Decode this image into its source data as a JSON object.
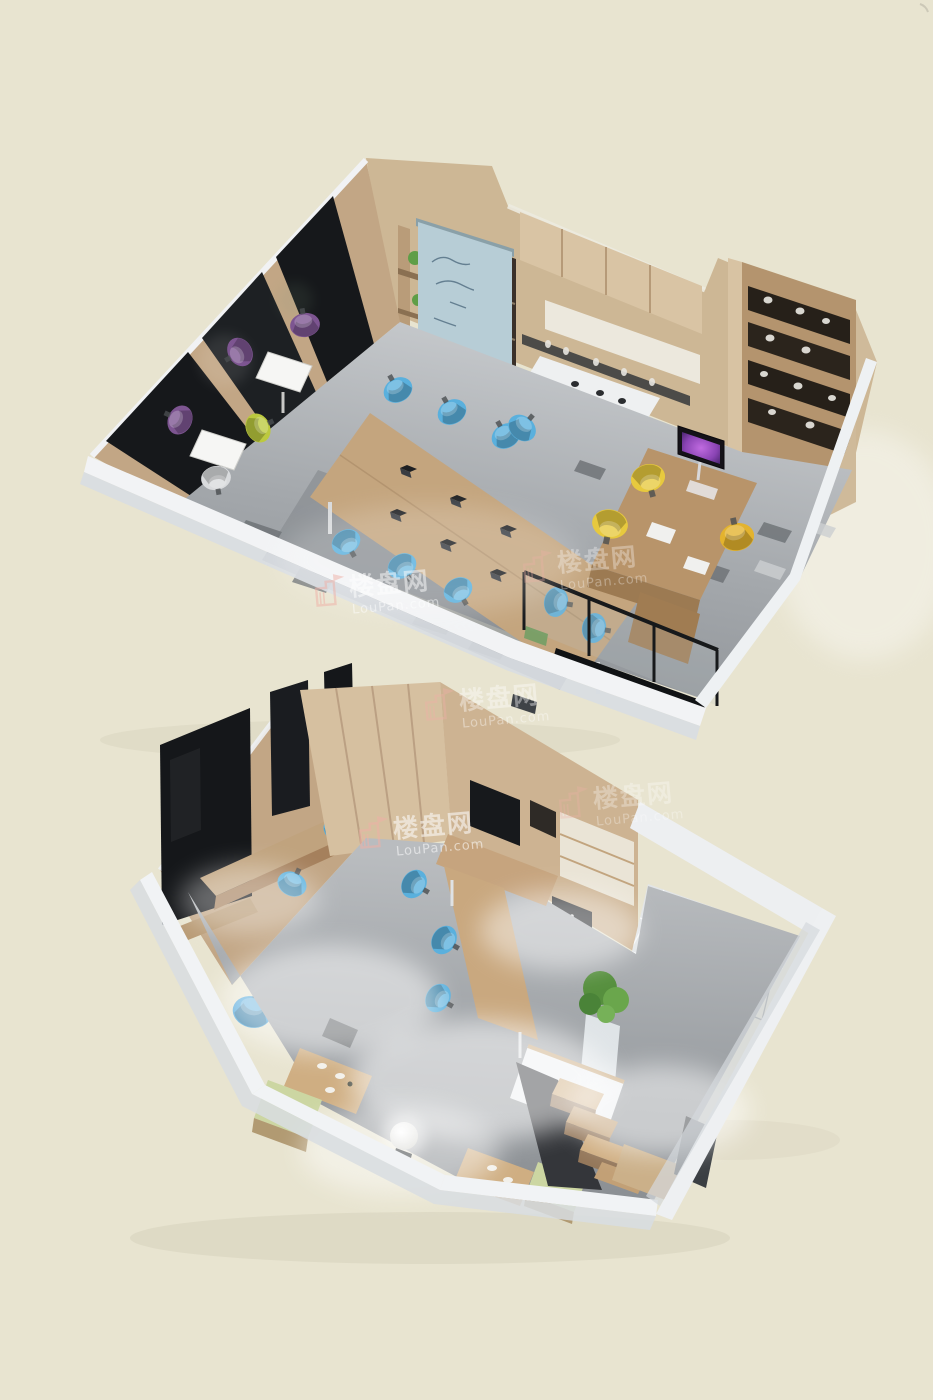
{
  "image": {
    "type": "3d-isometric-floorplan-render",
    "description": "Two-level loft office 3D floor plan rendering on a plain beige backdrop, upper open-plan office level above, lower studio level with kitchen, bathroom and staircase below",
    "background_color": "#e8e4d0",
    "levels": [
      {
        "id": "upper",
        "label": "Upper level - open plan office",
        "features": [
          "dark glass media wall panels",
          "wood shelving with green plants",
          "dark bookcase",
          "hanging blue writing board with chalk scribbles",
          "upper wood cabinets",
          "white bar counter with bottle shelves",
          "green bar stools",
          "long shared meeting table with laptops",
          "blue task chairs",
          "white bistro tables",
          "purple chairs",
          "lime chair",
          "executive desk with purple-screen monitor",
          "yellow lounge chairs",
          "tall display shelf with white ware",
          "glass stair balustrade",
          "dark stairwell opening",
          "grey concrete floor with dark tile patches"
        ]
      },
      {
        "id": "lower",
        "label": "Lower level - studio with kitchen, bath and staircase",
        "features": [
          "leaning presentation screens on media wall",
          "wall desk with blue chairs",
          "tall wardrobe cabinets",
          "media wall cabinet with TV",
          "appliance stack",
          "U-shaped work desk",
          "blue task chairs",
          "tall potted plant",
          "white kitchen island",
          "tiled bathroom floor",
          "sketched wireframe shower fitting",
          "dark accent wall panel",
          "timber staircase with landing",
          "under-stair void",
          "two dining tables with pale-green benches",
          "glowing sphere floor lamp",
          "concrete floor with white haze"
        ]
      }
    ]
  },
  "watermark": {
    "brand_cn": "楼盘网",
    "brand_en": "LouPan.com",
    "icon": "building-flag-icon",
    "text_color": "#ffffff",
    "icon_color": "#efb0a6",
    "instance_count": 5,
    "placements": [
      "upper floor front-left",
      "upper floor front-right",
      "between levels",
      "lower level left",
      "lower level centre-right"
    ]
  },
  "palette": {
    "background": "#e8e4d0",
    "outer_walls": "#f1f3f5",
    "wall_shadow": "#d8dde2",
    "wood_light": "#d6c0a0",
    "wood_mid": "#c2a685",
    "wood_dark": "#9c7a52",
    "glass_dark": "#16181b",
    "floor_grey": "#9aa0a5",
    "banner_blue": "#b7cdd6",
    "chair_blue": "#5ab0dd",
    "chair_purple": "#7d5591",
    "chair_yellow": "#e7c93e",
    "chair_lime": "#bcc93e",
    "stool_green": "#86c053",
    "plant_green": "#5f9e47",
    "monitor_purple": "#a05bc8",
    "tile_white": "#e2e5e7"
  }
}
